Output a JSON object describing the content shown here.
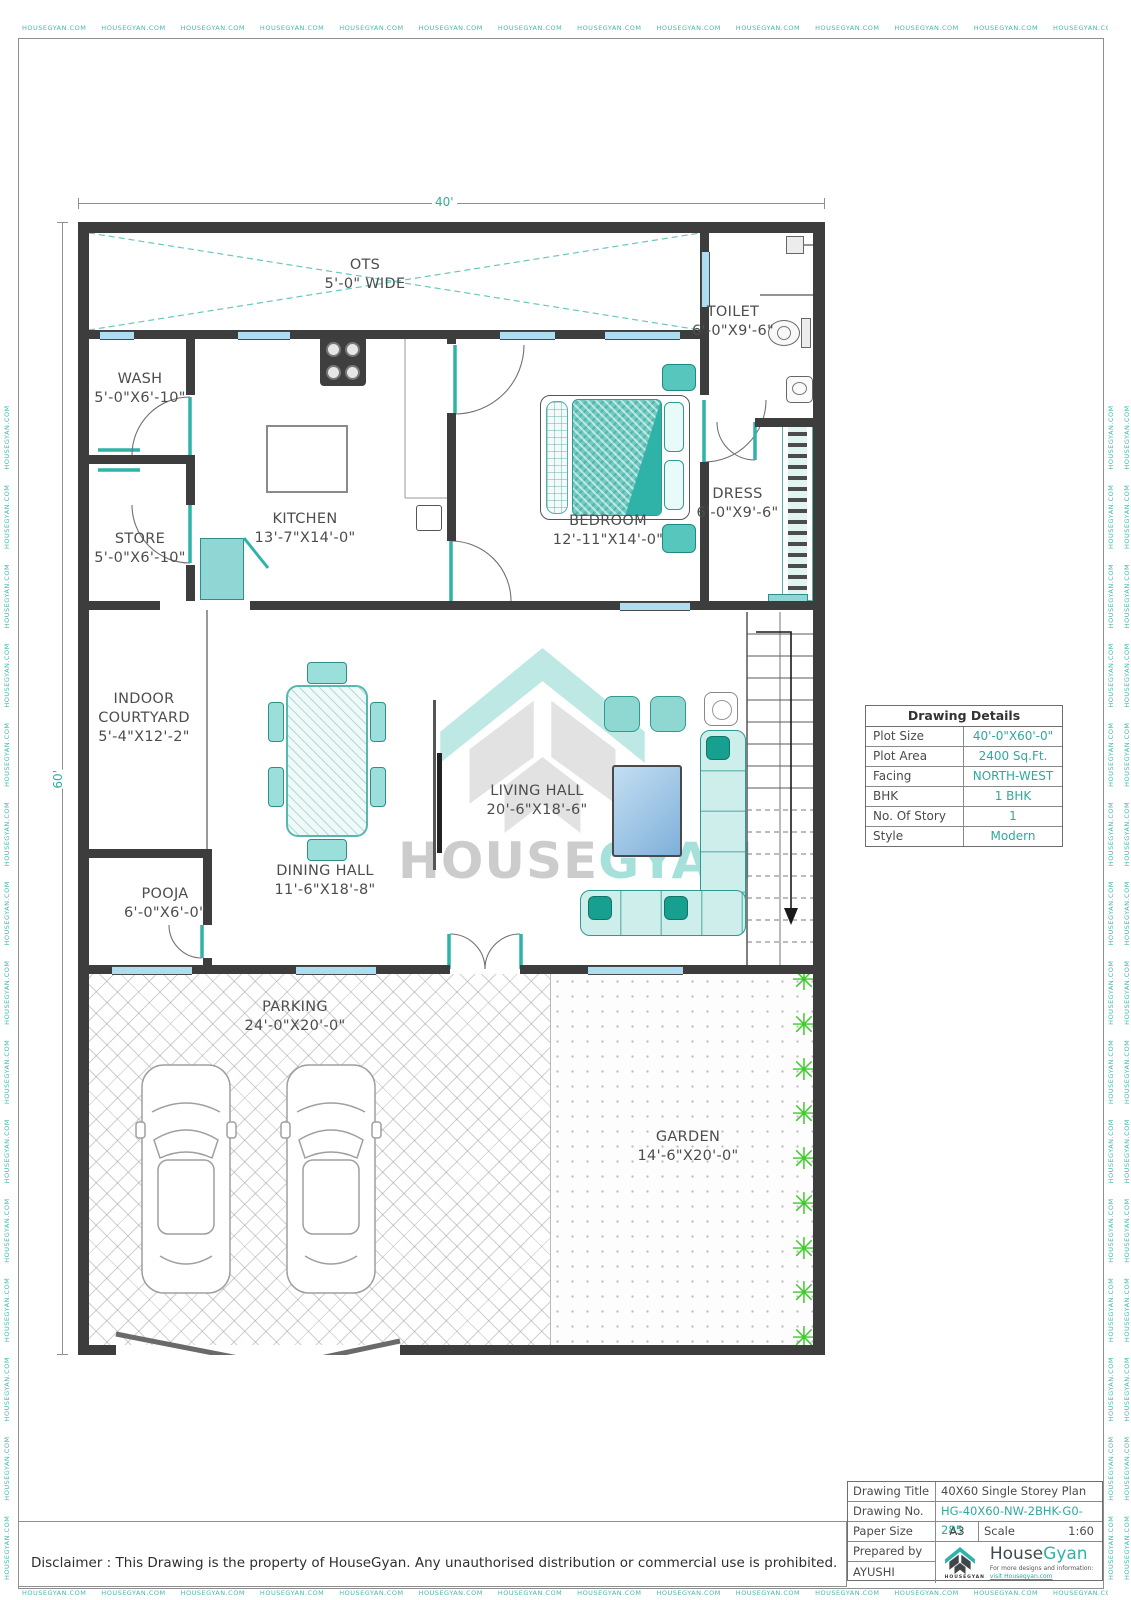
{
  "page": {
    "edge_watermark": "HOUSEGYAN.COM",
    "disclaimer": "Disclaimer : This Drawing is the property of HouseGyan. Any unauthorised distribution or commercial use is prohibited."
  },
  "dimensions": {
    "top": "40'",
    "left": "60'"
  },
  "watermark_center": {
    "brand_left": "HOUSE",
    "brand_right": "GYAN"
  },
  "rooms": {
    "ots": {
      "name": "OTS",
      "size": "5'-0\" WIDE"
    },
    "toilet": {
      "name": "TOILET",
      "size": "6'-0\"X9'-6\""
    },
    "wash": {
      "name": "WASH",
      "size": "5'-0\"X6'-10\""
    },
    "store": {
      "name": "STORE",
      "size": "5'-0\"X6'-10\""
    },
    "kitchen": {
      "name": "KITCHEN",
      "size": "13'-7\"X14'-0\""
    },
    "bedroom": {
      "name": "BEDROOM",
      "size": "12'-11\"X14'-0\""
    },
    "dress": {
      "name": "DRESS",
      "size": "6'-0\"X9'-6\""
    },
    "courtyard": {
      "name": "INDOOR COURTYARD",
      "size": "5'-4\"X12'-2\""
    },
    "pooja": {
      "name": "POOJA",
      "size": "6'-0\"X6'-0\""
    },
    "dining": {
      "name": "DINING HALL",
      "size": "11'-6\"X18'-8\""
    },
    "living": {
      "name": "LIVING HALL",
      "size": "20'-6\"X18'-6\""
    },
    "parking": {
      "name": "PARKING",
      "size": "24'-0\"X20'-0\""
    },
    "garden": {
      "name": "GARDEN",
      "size": "14'-6\"X20'-0\""
    }
  },
  "drawing_details": {
    "title": "Drawing Details",
    "rows": [
      {
        "label": "Plot Size",
        "value": "40'-0\"X60'-0\""
      },
      {
        "label": "Plot Area",
        "value": "2400 Sq.Ft."
      },
      {
        "label": "Facing",
        "value": "NORTH-WEST"
      },
      {
        "label": "BHK",
        "value": "1 BHK"
      },
      {
        "label": "No. Of Story",
        "value": "1"
      },
      {
        "label": "Style",
        "value": "Modern"
      }
    ]
  },
  "title_block": {
    "drawing_title_label": "Drawing Title",
    "drawing_title": "40X60 Single Storey Plan",
    "drawing_no_label": "Drawing No.",
    "drawing_no": "HG-40X60-NW-2BHK-G0-285",
    "paper_size_label": "Paper Size",
    "paper_size": "A3",
    "scale_label": "Scale",
    "scale": "1:60",
    "prepared_by_label": "Prepared by",
    "prepared_by": "AYUSHI"
  },
  "logo": {
    "brand_house": "House",
    "brand_gyan": "Gyan",
    "tagline_line1": "For more designs and information:",
    "tagline_line2": "visit Housegyan.com",
    "icon_caption": "HOUSEGYAN"
  },
  "colors": {
    "teal": "#2fb3a8",
    "wall": "#3d3d3d",
    "window": "#aeddf1",
    "plant_green": "#3ecb2b"
  }
}
